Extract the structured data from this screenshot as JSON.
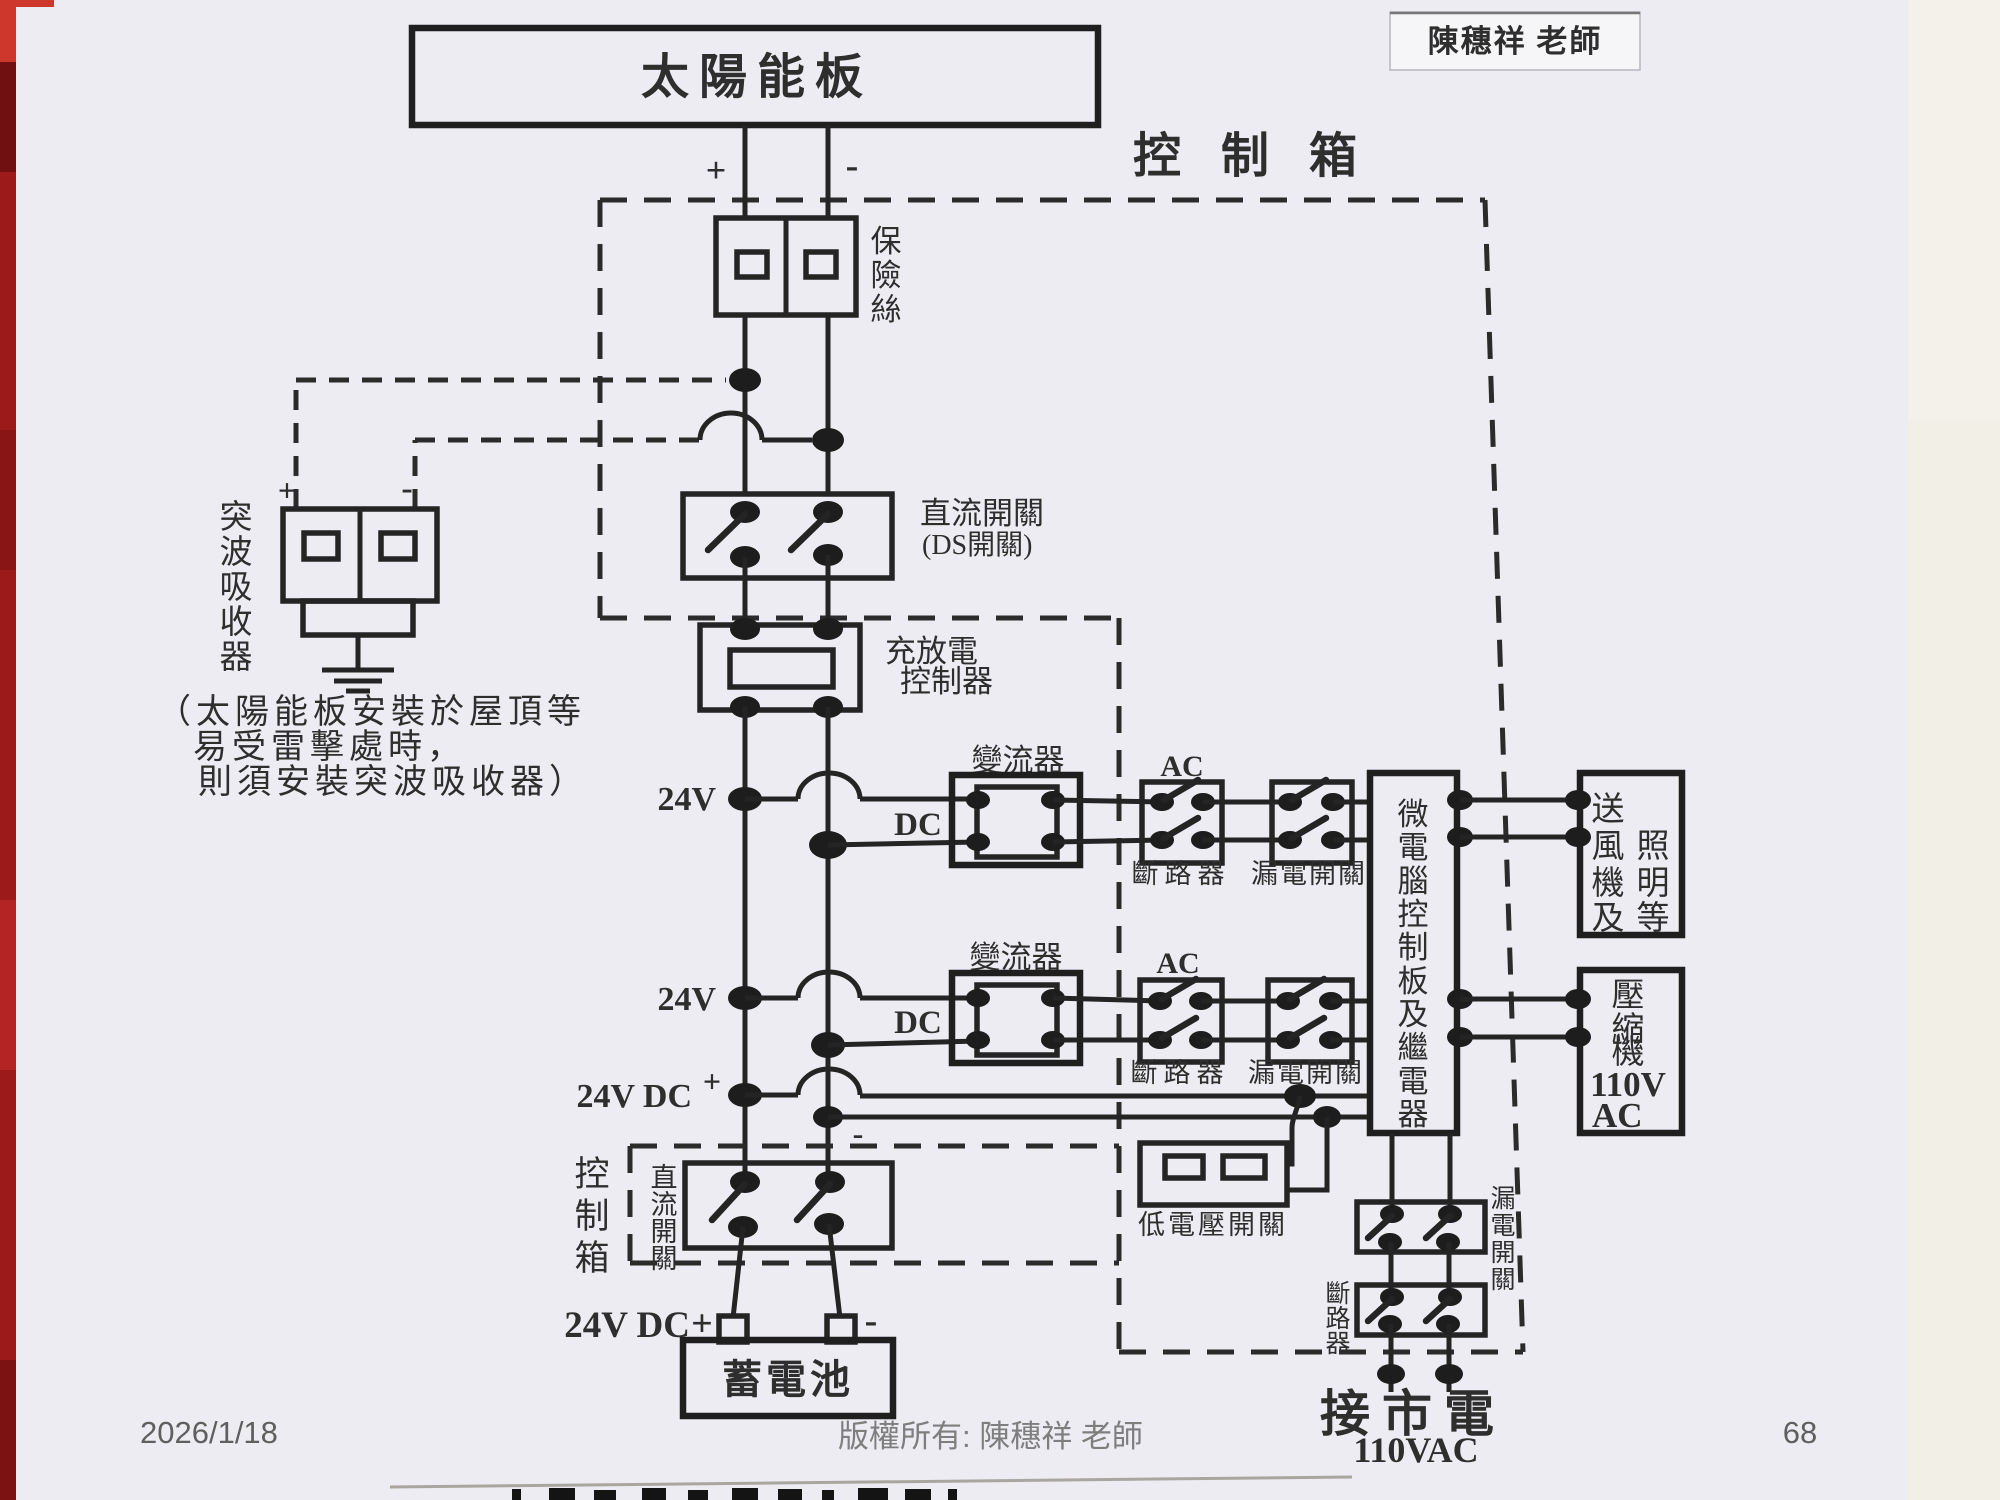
{
  "colors": {
    "page_bg": "#edecf2",
    "ink": "#242424",
    "footer_gray": "#5f5f5f",
    "copyright_gray": "#7e7e7e",
    "red_strip": "#9c1a1a",
    "right_strip": "#f2efe7"
  },
  "header": {
    "teacher_stamp": "陳穗祥  老師",
    "control_box_label": "控 制 箱"
  },
  "solar_panel": {
    "label": "太陽能板",
    "plus": "+",
    "minus": "-"
  },
  "fuse": {
    "chars": [
      "保",
      "險",
      "絲"
    ]
  },
  "surge": {
    "chars": [
      "突",
      "波",
      "吸",
      "收",
      "器"
    ],
    "plus": "+",
    "minus": "-",
    "note_lines": [
      "（太陽能板安裝於屋頂等",
      "易受雷擊處時，",
      "則須安裝突波吸收器）"
    ]
  },
  "dc_switch": {
    "line1": "直流開關",
    "line2": "(DS開關)"
  },
  "charge_controller": {
    "line1": "充放電",
    "line2": "控制器"
  },
  "bus": {
    "v24": "24V",
    "v24dc": "24V DC",
    "plus": "+",
    "minus": "-",
    "dc": "DC"
  },
  "inverter": {
    "label": "變流器"
  },
  "ac_block": {
    "ac": "AC",
    "breaker": "斷路器",
    "leakage": "漏電開關"
  },
  "micro": {
    "chars": [
      "微",
      "電",
      "腦",
      "控",
      "制",
      "板",
      "及",
      "繼",
      "電",
      "器"
    ]
  },
  "fan_load": {
    "chars": [
      "送",
      "風",
      "照",
      "機",
      "明",
      "及",
      "等"
    ]
  },
  "compressor_load": {
    "chars": [
      "壓",
      "縮",
      "機"
    ],
    "volt": "110V",
    "ac": "AC"
  },
  "low_voltage_switch": {
    "label": "低電壓開關"
  },
  "control_box2": {
    "chars": [
      "控",
      "制",
      "箱"
    ],
    "switch_chars": [
      "直",
      "流",
      "開",
      "關"
    ]
  },
  "battery": {
    "label": "蓄電池",
    "v24dc": "24V DC",
    "plus": "+",
    "minus": "-"
  },
  "mains": {
    "leakage_chars": [
      "漏",
      "電",
      "開",
      "關"
    ],
    "breaker_chars": [
      "斷",
      "路",
      "器"
    ],
    "label": "接市電",
    "voltage": "110VAC"
  },
  "footer": {
    "date": "2026/1/18",
    "copyright": "版權所有: 陳穗祥 老師",
    "page_number": "68"
  }
}
